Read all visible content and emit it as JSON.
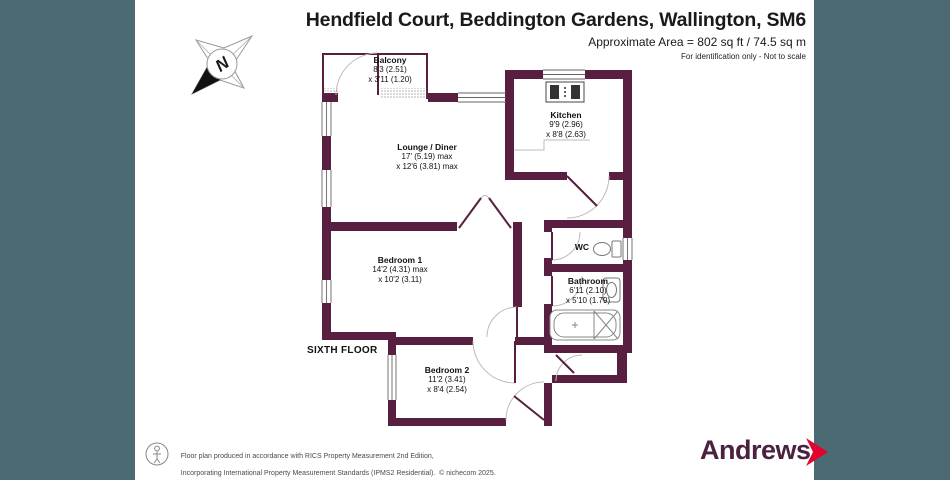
{
  "header": {
    "title": "Hendfield Court, Beddington Gardens, Wallington, SM6",
    "area": "Approximate Area = 802 sq ft / 74.5 sq m",
    "disclaimer": "For identification only - Not to scale"
  },
  "compass": {
    "letter": "N"
  },
  "floor_label": "SIXTH FLOOR",
  "rooms": [
    {
      "name": "Balcony",
      "dim1": "8'3 (2.51)",
      "dim2": "x 3'11 (1.20)"
    },
    {
      "name": "Lounge / Diner",
      "dim1": "17' (5.19) max",
      "dim2": "x 12'6 (3.81) max"
    },
    {
      "name": "Kitchen",
      "dim1": "9'9 (2.96)",
      "dim2": "x 8'8 (2.63)"
    },
    {
      "name": "Bedroom 1",
      "dim1": "14'2 (4.31) max",
      "dim2": "x 10'2 (3.11)"
    },
    {
      "name": "WC"
    },
    {
      "name": "Bathroom",
      "dim1": "6'11 (2.10)",
      "dim2": "x 5'10 (1.79)"
    },
    {
      "name": "Bedroom 2",
      "dim1": "11'2 (3.41)",
      "dim2": "x 8'4 (2.54)"
    }
  ],
  "footer": {
    "line1": "Floor plan produced in accordance with RICS Property Measurement 2nd Edition,",
    "line2": "Incorporating International Property Measurement Standards (IPMS2 Residential).  © nichecom 2025.",
    "line3": "Produced for Andrews Estate Agents.   REF: 1361665",
    "brand": "Andrews"
  },
  "colors": {
    "wall": "#581f41",
    "side_background": "#4c6a72",
    "brand_text": "#4b2140",
    "chevron_red": "#e4032e"
  }
}
